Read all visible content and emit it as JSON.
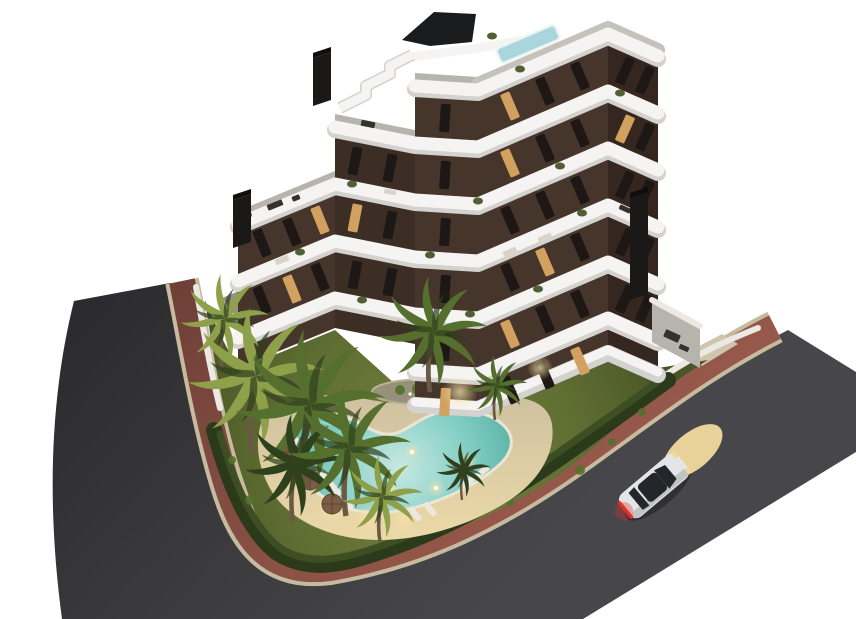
{
  "scene": {
    "description": "Aerial dusk 3D architectural rendering of a modern stepped apartment building with dark brown facades and curved white balcony bands, set on a corner plot with landscaped garden, free-form swimming pool, palm trees, perimeter hedge, red pedestrian sidewalk and two dark asphalt roads with a white car driving past",
    "time_of_day": "dusk",
    "background": "plain white studio background"
  },
  "building": {
    "floors_visible": 7,
    "style": "stepped zigzag block, terraced toward the left",
    "features": [
      "rooftop plunge pool",
      "roof terraces with furniture",
      "three dark chimney stacks",
      "exterior white staircase",
      "planted balconies",
      "lit windows"
    ]
  },
  "garden": {
    "pool_shape": "free-form boomerang with underwater lights",
    "loungers_count": 9,
    "umbrellas_count": 3,
    "palm_trees_count": 9,
    "island_bed": "oval planting bed with tall palm in lawn",
    "boundary": [
      "white perimeter wall",
      "dark clipped hedge"
    ]
  },
  "roads": {
    "left_road": "asphalt street receding to upper left",
    "right_road": "asphalt street receding to upper right",
    "sidewalk": "red-brown paved walk with light curbs wrapping the corner plot"
  },
  "vehicle": {
    "type": "white coupe",
    "state": "headlights on, red tail lights lit",
    "position": "right road, heading upper-right"
  },
  "colors": {
    "bg": "#ffffff",
    "asphalt": "#3a3a3d",
    "curb": "#c6ba9f",
    "sidewalk": "#96584a",
    "sidewalk_dark": "#6e4038",
    "lawn": "#5f6e33",
    "lawn_dark": "#4a5626",
    "hedge": "#2c3a1c",
    "hedge_light": "#3c4e22",
    "wall": "#ece9e4",
    "deck": "#cfc2a0",
    "deck_lit": "#ecd9a8",
    "pool_shallow": "#c6e8e1",
    "pool_mid": "#84cfc5",
    "pool_deep": "#58b0a6",
    "pool_rim": "#ebe5d3",
    "island": "#97917b",
    "facade": "#46352b",
    "band": "#f5f4f2",
    "band_shadow": "#d3d2cf",
    "terrace": "#b7b4ae",
    "roof_gray": "#c5c2bc",
    "slab_dark": "#191b1d",
    "chimney": "#1b1917",
    "rooftop_pool": "#a9d5dd",
    "window": "#1d1815",
    "window_lit": "#d2a160",
    "trunk": "#6b5a43",
    "palm": "#55702e",
    "palm_light": "#8ea04a",
    "palm_dark": "#2e401c",
    "lounger": "#ece8dd",
    "umbrella": "#7c5e44",
    "car_body": "#e4e5e6",
    "car_glass": "#23262a",
    "tail_red": "#e0322a",
    "headlight": "#e8d29a"
  }
}
